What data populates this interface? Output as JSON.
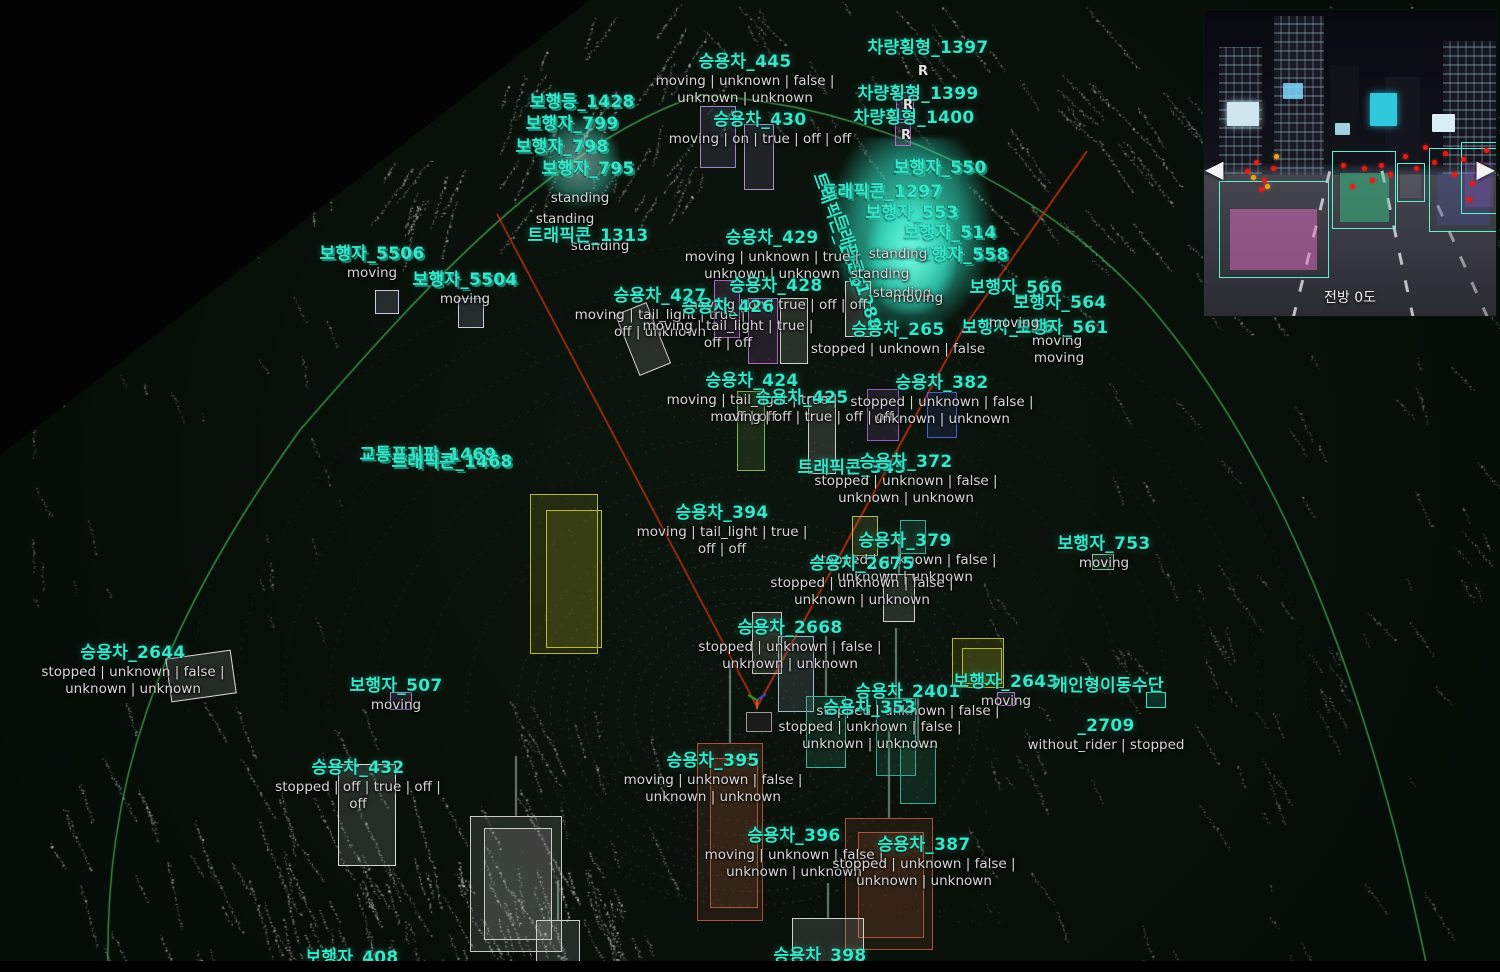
{
  "scene": {
    "background": "#060d07",
    "label_color": "#35e6c8",
    "status_color": "#d6d6d6",
    "arc_color": "#46a050",
    "red_line_color": "#c23018",
    "point_color": "#cfd4cf"
  },
  "camera_inset": {
    "caption": "전방 0도",
    "prev_arrow": "◀",
    "next_arrow": "▶",
    "detections": [
      {
        "x": 5,
        "y": 56,
        "w": 37,
        "h": 31,
        "fill": "rgba(232,111,200,0.5)"
      },
      {
        "x": 44,
        "y": 46,
        "w": 21,
        "h": 25,
        "fill": "rgba(56,216,144,0.45)"
      },
      {
        "x": 66,
        "y": 50,
        "w": 9,
        "h": 12,
        "fill": "rgba(255,255,255,0.08)"
      },
      {
        "x": 77,
        "y": 45,
        "w": 23,
        "h": 27,
        "fill": "rgba(80,100,220,0.2)"
      },
      {
        "x": 88,
        "y": 43,
        "w": 12,
        "h": 23,
        "fill": "rgba(150,80,200,0.25)"
      }
    ],
    "red_dots": [
      [
        14,
        52
      ],
      [
        17,
        49
      ],
      [
        20,
        55
      ],
      [
        23,
        51
      ],
      [
        19,
        58
      ],
      [
        47,
        50
      ],
      [
        50,
        57
      ],
      [
        54,
        51
      ],
      [
        57,
        55
      ],
      [
        60,
        50
      ],
      [
        63,
        53
      ],
      [
        68,
        47
      ],
      [
        72,
        51
      ],
      [
        75,
        44
      ],
      [
        78,
        49
      ],
      [
        82,
        46
      ],
      [
        85,
        53
      ],
      [
        88,
        48
      ],
      [
        91,
        56
      ],
      [
        94,
        50
      ],
      [
        96,
        45
      ],
      [
        90,
        61
      ]
    ],
    "amber_dots": [
      [
        16,
        54
      ],
      [
        21,
        57
      ],
      [
        24,
        47
      ]
    ]
  },
  "objects": [
    {
      "title": "승용차_445",
      "x": 745,
      "y": 52,
      "status": [
        "moving | unknown | false |",
        "unknown | unknown"
      ]
    },
    {
      "title": "차량횡형_1397",
      "x": 928,
      "y": 38
    },
    {
      "title": "차량횡형_1399",
      "x": 918,
      "y": 84
    },
    {
      "title": "차량횡형_1400",
      "x": 914,
      "y": 108
    },
    {
      "title": "보행등_1428",
      "x": 582,
      "y": 92,
      "dbl": true
    },
    {
      "title": "보행자_799",
      "x": 572,
      "y": 114,
      "dbl": true
    },
    {
      "title": "보행자_798",
      "x": 562,
      "y": 137,
      "dbl": true
    },
    {
      "title": "보행자_795",
      "x": 588,
      "y": 159,
      "dbl": true
    },
    {
      "title": "",
      "x": 580,
      "y": 190,
      "status": [
        "standing"
      ]
    },
    {
      "title": "",
      "x": 565,
      "y": 211,
      "status": [
        "standing"
      ]
    },
    {
      "title": "",
      "x": 600,
      "y": 238,
      "status": [
        "standing"
      ]
    },
    {
      "title": "승용차_430",
      "x": 760,
      "y": 110,
      "status": [
        "moving | on | true | off | off"
      ]
    },
    {
      "title": "트래픽콘_1313",
      "x": 588,
      "y": 226
    },
    {
      "title": "트래픽콘_1297",
      "x": 882,
      "y": 182,
      "dbl": true
    },
    {
      "title": "트래픽콘_1286",
      "x": 838,
      "y": 220,
      "rot": 70
    },
    {
      "title": "트래픽콘_1288",
      "x": 856,
      "y": 262,
      "rot": 72
    },
    {
      "title": "보행자_550",
      "x": 940,
      "y": 158,
      "dbl": true
    },
    {
      "title": "보행자_553",
      "x": 912,
      "y": 203,
      "dbl": true
    },
    {
      "title": "보행자_514",
      "x": 950,
      "y": 223,
      "dbl": true
    },
    {
      "title": "보행자_558",
      "x": 962,
      "y": 245,
      "dbl": true
    },
    {
      "title": "",
      "x": 898,
      "y": 246,
      "status": [
        "standing"
      ]
    },
    {
      "title": "",
      "x": 880,
      "y": 266,
      "status": [
        "standing"
      ]
    },
    {
      "title": "",
      "x": 902,
      "y": 285,
      "status": [
        "standing"
      ]
    },
    {
      "title": "",
      "x": 918,
      "y": 290,
      "status": [
        "moving"
      ]
    },
    {
      "title": "보행자_5506",
      "x": 372,
      "y": 244,
      "dbl": true,
      "status": [
        "moving"
      ]
    },
    {
      "title": "보행자_5504",
      "x": 465,
      "y": 270,
      "dbl": true,
      "status": [
        "moving"
      ]
    },
    {
      "title": "승용차_429",
      "x": 772,
      "y": 228,
      "status": [
        "moving | unknown | true |",
        "unknown | unknown"
      ]
    },
    {
      "title": "승용차_427",
      "x": 660,
      "y": 286,
      "status": [
        "moving | tail_light | true |",
        "off | unknown"
      ]
    },
    {
      "title": "승용차_428",
      "x": 776,
      "y": 276,
      "status": [
        "moving | on | true | off | off"
      ]
    },
    {
      "title": "승용차_426",
      "x": 728,
      "y": 297,
      "status": [
        "moving | tail_light | true |",
        "off | off"
      ]
    },
    {
      "title": "보행자_566",
      "x": 1016,
      "y": 278
    },
    {
      "title": "보행자_556",
      "x": 1008,
      "y": 318
    },
    {
      "title": "보행자_564",
      "x": 1060,
      "y": 293
    },
    {
      "title": "보행자_561",
      "x": 1062,
      "y": 318
    },
    {
      "title": "승용차_265",
      "x": 898,
      "y": 320,
      "status": [
        "stopped | unknown | false"
      ]
    },
    {
      "title": "",
      "x": 1014,
      "y": 315,
      "status": [
        "moving"
      ]
    },
    {
      "title": "",
      "x": 1057,
      "y": 333,
      "status": [
        "moving"
      ]
    },
    {
      "title": "",
      "x": 1059,
      "y": 350,
      "status": [
        "moving"
      ]
    },
    {
      "title": "승용차_424",
      "x": 752,
      "y": 371,
      "status": [
        "moving | tail_light | true |",
        "off | off"
      ]
    },
    {
      "title": "승용차_425",
      "x": 802,
      "y": 388,
      "status": [
        "moving | off | true | off | off"
      ]
    },
    {
      "title": "승용차_382",
      "x": 942,
      "y": 373,
      "status": [
        "stopped | unknown | false |",
        "unknown | unknown"
      ]
    },
    {
      "title": "트래픽콘_345",
      "x": 852,
      "y": 458
    },
    {
      "title": "승용차_372",
      "x": 906,
      "y": 452,
      "status": [
        "stopped | unknown | false |",
        "unknown | unknown"
      ]
    },
    {
      "title": "승용차_394",
      "x": 722,
      "y": 503,
      "status": [
        "moving | tail_light | true |",
        "off | off"
      ]
    },
    {
      "title": "승용차_379",
      "x": 905,
      "y": 531,
      "status": [
        "stopped | unknown | false |",
        "unknown | unknown"
      ]
    },
    {
      "title": "승용차_2675",
      "x": 862,
      "y": 554,
      "status": [
        "stopped | unknown | false |",
        "unknown | unknown"
      ]
    },
    {
      "title": "승용차_2668",
      "x": 790,
      "y": 618,
      "status": [
        "stopped | unknown | false |",
        "unknown | unknown"
      ]
    },
    {
      "title": "교통표지판_1469",
      "x": 428,
      "y": 445,
      "dbl": true
    },
    {
      "title": "트래픽콘_1468",
      "x": 452,
      "y": 452,
      "dbl": true
    },
    {
      "title": "승용차_2644",
      "x": 133,
      "y": 643,
      "status": [
        "stopped | unknown | false |",
        "unknown | unknown"
      ]
    },
    {
      "title": "보행자_507",
      "x": 396,
      "y": 676,
      "status": [
        "moving"
      ]
    },
    {
      "title": "승용차_432",
      "x": 358,
      "y": 758,
      "status": [
        "stopped | off | true | off |",
        "off"
      ]
    },
    {
      "title": "승용차_2401",
      "x": 908,
      "y": 682,
      "status": [
        "stopped | unknown | false |"
      ]
    },
    {
      "title": "승용차_353",
      "x": 870,
      "y": 698,
      "status": [
        "stopped | unknown | false |",
        "unknown | unknown"
      ]
    },
    {
      "title": "보행자_2643",
      "x": 1006,
      "y": 672,
      "status": [
        "moving"
      ]
    },
    {
      "title": "개인형이동수단",
      "x": 1108,
      "y": 676
    },
    {
      "title": "_2709",
      "x": 1106,
      "y": 716,
      "status": [
        "without_rider | stopped"
      ]
    },
    {
      "title": "보행자_753",
      "x": 1104,
      "y": 534,
      "status": [
        "moving"
      ]
    },
    {
      "title": "승용차_395",
      "x": 713,
      "y": 751,
      "status": [
        "moving | unknown | false |",
        "unknown | unknown"
      ]
    },
    {
      "title": "승용차_396",
      "x": 794,
      "y": 826,
      "status": [
        "moving | unknown | false |",
        "unknown | unknown"
      ]
    },
    {
      "title": "승용차_387",
      "x": 924,
      "y": 835,
      "status": [
        "stopped | unknown | false |",
        "unknown | unknown"
      ]
    },
    {
      "title": "승용차_398",
      "x": 820,
      "y": 946
    },
    {
      "title": "보행자_408",
      "x": 352,
      "y": 948
    }
  ],
  "markers": [
    {
      "t": "R",
      "x": 923,
      "y": 64
    },
    {
      "t": "R",
      "x": 908,
      "y": 98
    },
    {
      "t": "R",
      "x": 906,
      "y": 128
    }
  ],
  "boxes": [
    {
      "x": 700,
      "y": 106,
      "w": 36,
      "h": 62,
      "c": "#9a86c8"
    },
    {
      "x": 744,
      "y": 124,
      "w": 30,
      "h": 66,
      "c": "#a88fc8"
    },
    {
      "x": 896,
      "y": 92,
      "w": 18,
      "h": 28,
      "c": "#b565c8"
    },
    {
      "x": 895,
      "y": 122,
      "w": 16,
      "h": 24,
      "c": "#b565c8"
    },
    {
      "x": 714,
      "y": 280,
      "w": 26,
      "h": 58,
      "c": "#b565c8"
    },
    {
      "x": 748,
      "y": 298,
      "w": 30,
      "h": 66,
      "c": "#b565c8"
    },
    {
      "x": 780,
      "y": 298,
      "w": 28,
      "h": 66,
      "c": "#cfcfcf"
    },
    {
      "x": 845,
      "y": 281,
      "w": 26,
      "h": 56,
      "c": "#cfcfcf"
    },
    {
      "x": 626,
      "y": 306,
      "w": 34,
      "h": 66,
      "c": "#cfcfcf",
      "rot": -22
    },
    {
      "x": 737,
      "y": 391,
      "w": 28,
      "h": 80,
      "c": "#7ab648"
    },
    {
      "x": 808,
      "y": 396,
      "w": 28,
      "h": 78,
      "c": "#cfcfcf"
    },
    {
      "x": 867,
      "y": 389,
      "w": 32,
      "h": 52,
      "c": "#9b59c0"
    },
    {
      "x": 927,
      "y": 392,
      "w": 30,
      "h": 46,
      "c": "#4a5fd0"
    },
    {
      "x": 852,
      "y": 516,
      "w": 26,
      "h": 40,
      "c": "#b8b860"
    },
    {
      "x": 900,
      "y": 520,
      "w": 26,
      "h": 34,
      "c": "#35b09a"
    },
    {
      "x": 883,
      "y": 574,
      "w": 32,
      "h": 48,
      "c": "#cfcfcf",
      "pole": 40
    },
    {
      "x": 752,
      "y": 612,
      "w": 30,
      "h": 62,
      "c": "#c9c9bb"
    },
    {
      "x": 778,
      "y": 636,
      "w": 36,
      "h": 76,
      "c": "#9fb8c8"
    },
    {
      "x": 806,
      "y": 696,
      "w": 40,
      "h": 72,
      "c": "#45b39b",
      "pole": 60
    },
    {
      "x": 876,
      "y": 698,
      "w": 40,
      "h": 78,
      "c": "#3aa890",
      "pole": 70
    },
    {
      "x": 900,
      "y": 746,
      "w": 36,
      "h": 58,
      "c": "#3aa890",
      "pole": 55
    },
    {
      "x": 697,
      "y": 743,
      "w": 66,
      "h": 178,
      "c": "#a8543a",
      "pole": 80
    },
    {
      "x": 710,
      "y": 758,
      "w": 48,
      "h": 150,
      "c": "#a8543a"
    },
    {
      "x": 845,
      "y": 818,
      "w": 88,
      "h": 132,
      "c": "#a8543a",
      "pole": 90
    },
    {
      "x": 858,
      "y": 832,
      "w": 66,
      "h": 106,
      "c": "#a8543a"
    },
    {
      "x": 470,
      "y": 816,
      "w": 92,
      "h": 136,
      "c": "#c9c9c9",
      "pole": 60
    },
    {
      "x": 484,
      "y": 828,
      "w": 68,
      "h": 112,
      "c": "#c9c9c9"
    },
    {
      "x": 536,
      "y": 920,
      "w": 44,
      "h": 48,
      "c": "#cfcfcf",
      "pole": 40
    },
    {
      "x": 792,
      "y": 918,
      "w": 72,
      "h": 50,
      "c": "#d0d0d0",
      "pole": 35
    },
    {
      "x": 338,
      "y": 764,
      "w": 58,
      "h": 102,
      "c": "#d8d8d8"
    },
    {
      "x": 168,
      "y": 654,
      "w": 66,
      "h": 44,
      "c": "#d8d8d8",
      "rot": -8
    },
    {
      "x": 375,
      "y": 290,
      "w": 24,
      "h": 24,
      "c": "#c8c8e8"
    },
    {
      "x": 458,
      "y": 298,
      "w": 26,
      "h": 30,
      "c": "#c8c8e8"
    },
    {
      "x": 390,
      "y": 692,
      "w": 22,
      "h": 18,
      "c": "#b080d0"
    },
    {
      "x": 1092,
      "y": 554,
      "w": 22,
      "h": 16,
      "c": "#8fc8a0"
    },
    {
      "x": 1146,
      "y": 692,
      "w": 20,
      "h": 16,
      "c": "#35e6c8"
    },
    {
      "x": 997,
      "y": 692,
      "w": 18,
      "h": 14,
      "c": "#b080d0"
    },
    {
      "x": 952,
      "y": 638,
      "w": 52,
      "h": 50,
      "c": "#b8b832"
    },
    {
      "x": 962,
      "y": 648,
      "w": 40,
      "h": 36,
      "c": "#b8b832"
    },
    {
      "x": 530,
      "y": 494,
      "w": 68,
      "h": 160,
      "c": "#b8b832"
    },
    {
      "x": 546,
      "y": 510,
      "w": 56,
      "h": 138,
      "c": "#b8b832"
    },
    {
      "x": 746,
      "y": 712,
      "w": 26,
      "h": 20,
      "c": "#9a9a9a",
      "fill": "#1a1a1a"
    }
  ],
  "red_lines": [
    [
      497,
      214,
      757,
      707
    ],
    [
      757,
      707,
      963,
      329
    ],
    [
      963,
      329,
      1087,
      151
    ]
  ],
  "green_arc": {
    "start": [
      108,
      972
    ],
    "segments": [
      [
        105,
        790,
        150,
        640,
        300,
        430
      ],
      [
        430,
        280,
        560,
        140,
        700,
        95
      ],
      [
        880,
        105,
        1040,
        190,
        1140,
        295
      ],
      [
        1260,
        430,
        1360,
        640,
        1428,
        972
      ]
    ]
  }
}
